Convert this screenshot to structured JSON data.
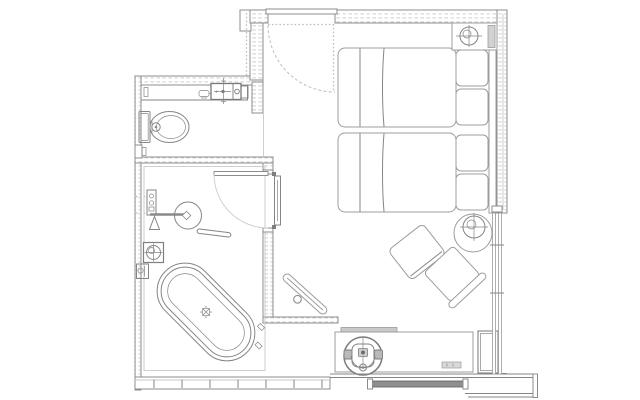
{
  "document": {
    "kind": "architectural-floor-plan",
    "subject": "hotel guest room with twin beds, bathroom, WC and entry",
    "visible_text": "none"
  },
  "palette": {
    "background": "#ffffff",
    "wall": "#8c8c8c",
    "furniture": "#9c9c9c",
    "fixture": "#858585",
    "dark": "#5f5f5f",
    "dashed": "#bdbdbd",
    "faint": "#c9c9c9",
    "infill": "#cfcfcf",
    "glazing": "#8f8f8f",
    "shade": "#d2d2d2"
  },
  "plan": {
    "rooms": [
      "entry-vestibule",
      "wc-room",
      "bathroom",
      "bedroom"
    ],
    "wc_room_fixtures": [
      "vanity-counter",
      "counter-accessory",
      "faucet",
      "wash-basin",
      "toilet"
    ],
    "bathroom_fixtures": [
      "shower-mixer",
      "shower-arm",
      "rain-shower-head",
      "floor-tub-filler",
      "freestanding-oval-bathtub",
      "floor-drain",
      "bath-shelf",
      "swing-door"
    ],
    "bedroom_furniture": [
      "twin-bed-1",
      "twin-bed-2",
      "pillows",
      "headboard",
      "nightstand",
      "table-lamp-symbol",
      "round-side-table",
      "lounge-stool",
      "armchair",
      "luggage-bench",
      "desk",
      "desk-chair",
      "minibar-cabinet"
    ],
    "openings": [
      "entry-door-swing",
      "bathroom-door-swing",
      "wc-doorway",
      "window-wall-south",
      "window-wall-east",
      "glazing-panel"
    ],
    "symbols": [
      {
        "name": "lamp-symbol",
        "glyph": "circle-with-crosshair"
      },
      {
        "name": "drain-symbol",
        "glyph": "square-with-x"
      },
      {
        "name": "door-swing",
        "glyph": "quarter-arc"
      }
    ]
  }
}
